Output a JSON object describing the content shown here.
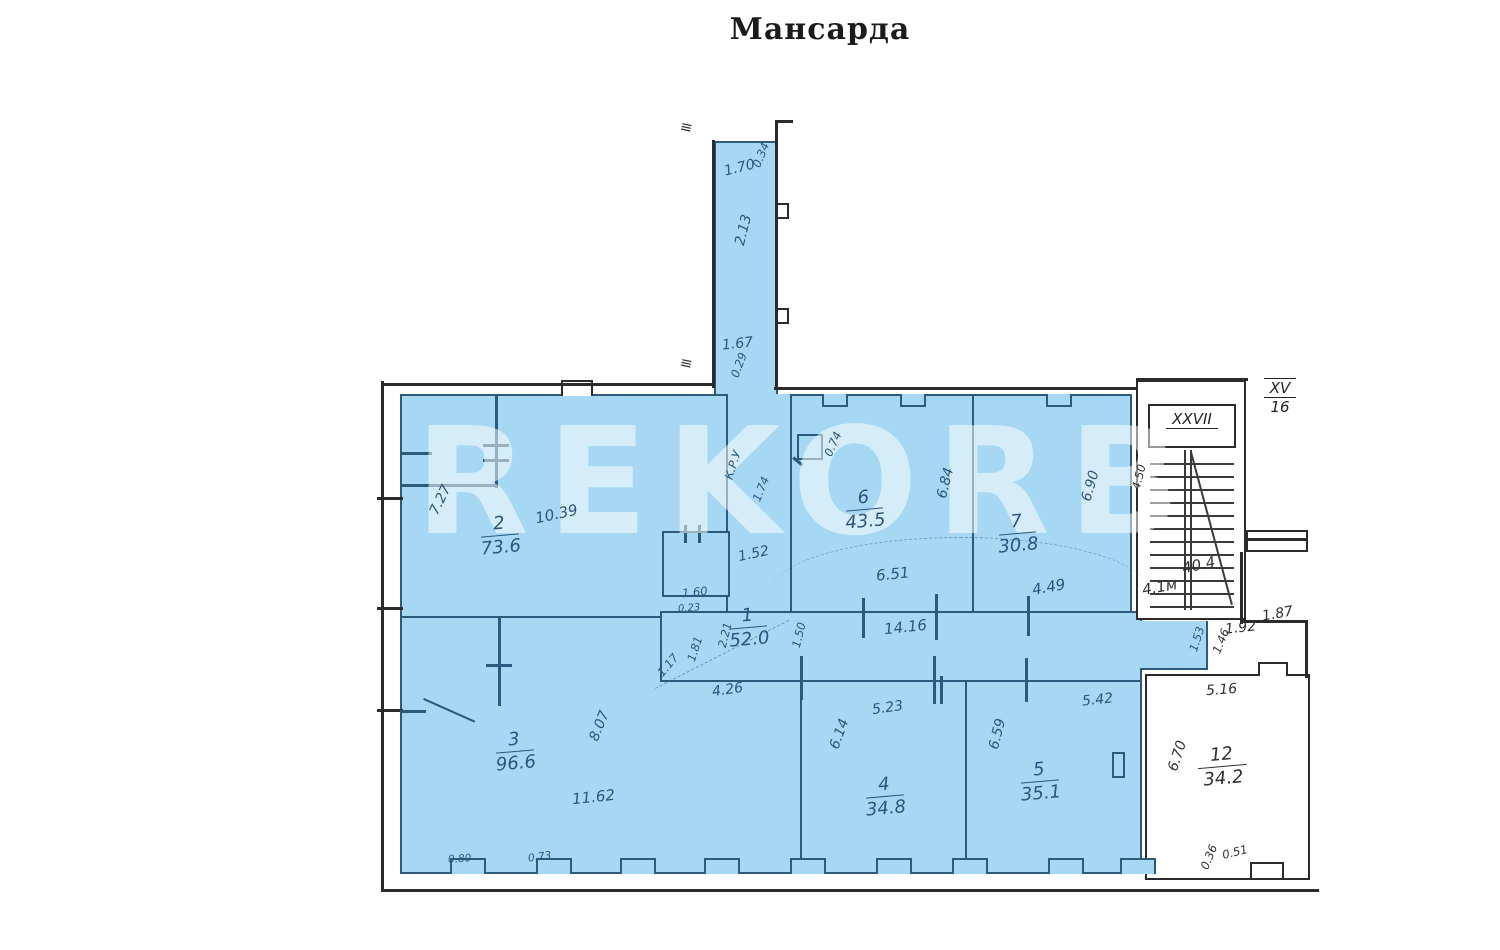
{
  "title": "Мансарда",
  "watermark": "REKORB",
  "colors": {
    "highlight": "#a7d8f3",
    "wall_on_blue": "#2c5a7c",
    "wall_outer": "#2b2b2b",
    "ink": "#2b5580"
  },
  "rooms": {
    "r1": {
      "number": "1",
      "area": "52.0"
    },
    "r2": {
      "number": "2",
      "area": "73.6"
    },
    "r3": {
      "number": "3",
      "area": "96.6"
    },
    "r4": {
      "number": "4",
      "area": "34.8"
    },
    "r5": {
      "number": "5",
      "area": "35.1"
    },
    "r6": {
      "number": "6",
      "area": "43.5"
    },
    "r7": {
      "number": "7",
      "area": "30.8"
    },
    "r12": {
      "number": "12",
      "area": "34.2"
    }
  },
  "stairwell": {
    "flight_label": "XXVII",
    "area_label": "40.4",
    "mark": "4.1м",
    "width_label": "4.50"
  },
  "exterior_flight": {
    "top": "XV",
    "bottom": "16"
  },
  "dims": {
    "c170": "1.70",
    "c034": "0.34",
    "c213": "2.13",
    "c167": "1.67",
    "c029": "0.29",
    "r2_1039": "10.39",
    "r2_727": "7.27",
    "r6_651": "6.51",
    "r6_684": "6.84",
    "r6_074": "0.74",
    "r7_449": "4.49",
    "r7_690": "6.90",
    "w1416": "14.16",
    "c1_152": "1.52",
    "c1_160": "1.60",
    "c1_023": "0.23",
    "c1_221": "2.21",
    "c1_181": "1.81",
    "c1_150": "1.50",
    "c1_426": "4.26",
    "c1_117": "1.17",
    "r3_1162": "11.62",
    "r3_807": "8.07",
    "r3_080": "0.80",
    "r3_073": "0.73",
    "r4_523": "5.23",
    "r4_614": "6.14",
    "r5_542": "5.42",
    "r5_659": "6.59",
    "r12_670": "6.70",
    "r12_036": "0.36",
    "r12_051": "0.51",
    "e187": "1.87",
    "e192": "1.92",
    "e146": "1.46",
    "e153": "1.53",
    "e516": "5.16",
    "a_krv": "К.Р.У",
    "a_174": "1.74"
  }
}
